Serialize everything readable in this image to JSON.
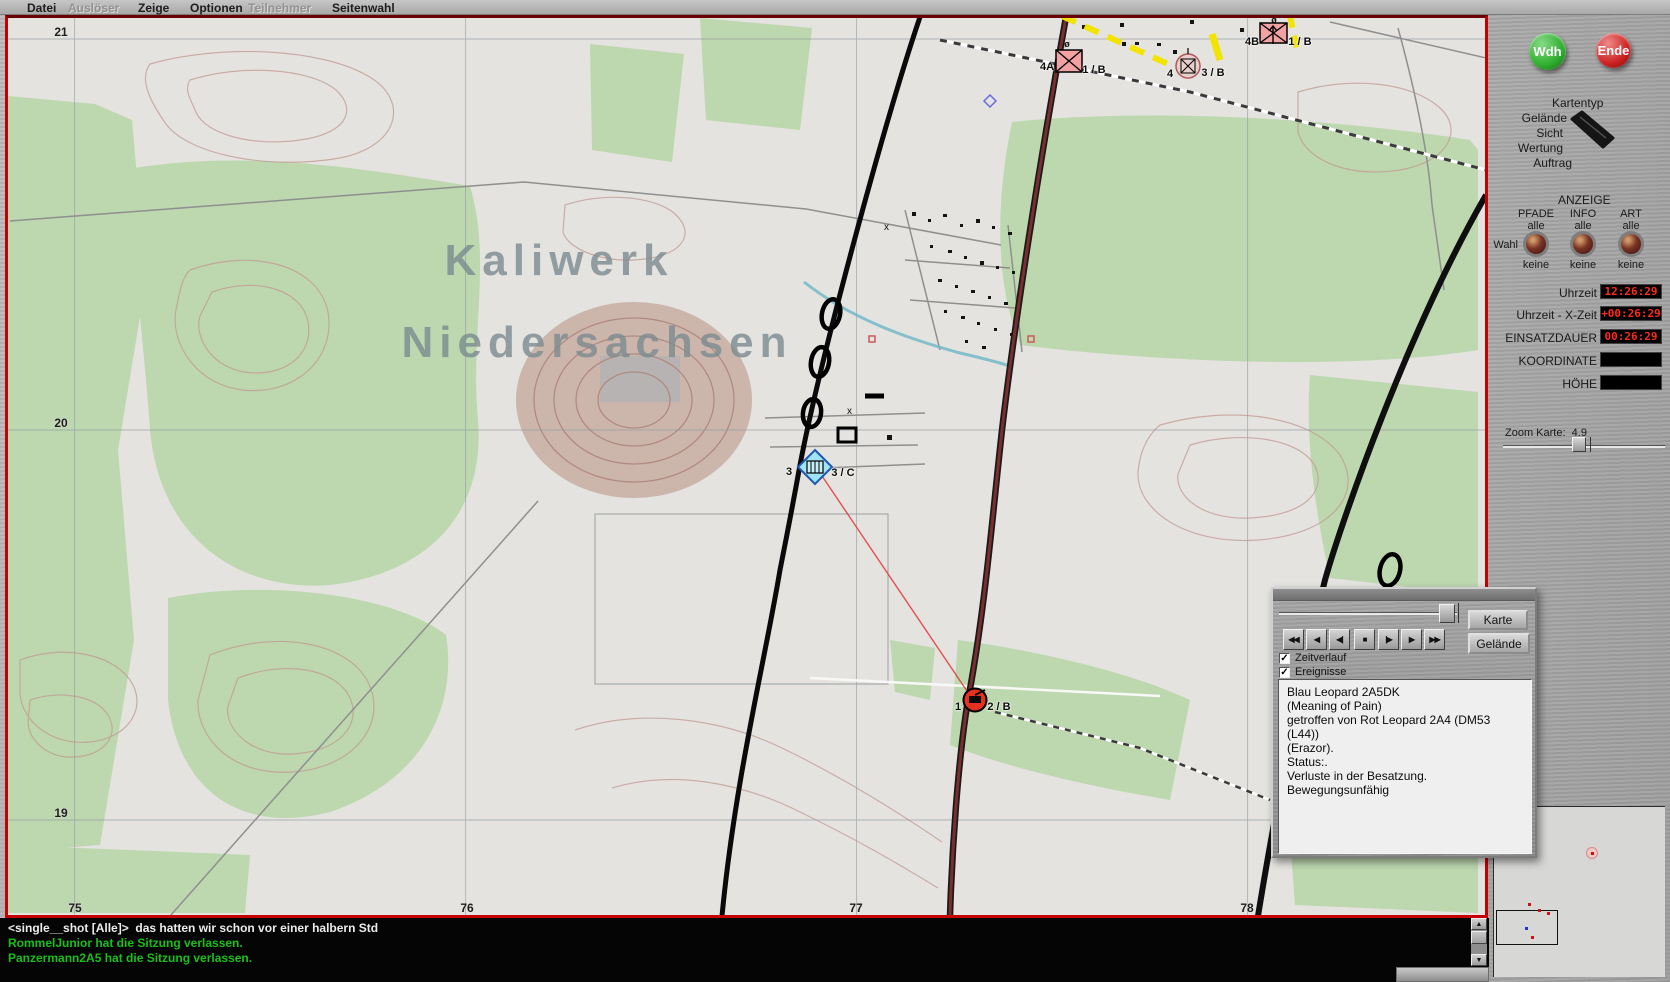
{
  "colors": {
    "metal": "#adadad",
    "led": "#ff2a1a",
    "map-border": "#c40000",
    "chat-green": "#18c018",
    "wdh-green": "#2fae2f",
    "ende-red": "#cc2222",
    "enemy-pink": "#f2a2a2",
    "friendly-blue": "#9fe4f4"
  },
  "menu": {
    "items": [
      {
        "label": "Datei",
        "enabled": true
      },
      {
        "label": "Auslöser",
        "enabled": false
      },
      {
        "label": "Zeige",
        "enabled": true
      },
      {
        "label": "Optionen",
        "enabled": true
      },
      {
        "label": "Teilnehmer",
        "enabled": false
      },
      {
        "label": "Seitenwahl",
        "enabled": true
      }
    ]
  },
  "map": {
    "watermark_line1": "Kaliwerk",
    "watermark_line2": "Niedersachsen",
    "grid": {
      "row_labels": [
        "21",
        "20",
        "19"
      ],
      "col_labels": [
        "75",
        "76",
        "77",
        "78"
      ]
    },
    "units": [
      {
        "left_label": "4A",
        "right_label": "1 / B",
        "marker": "ø"
      },
      {
        "left_label": "4",
        "right_label": "3 / B",
        "marker": ""
      },
      {
        "left_label": "4B",
        "right_label": "1 / B",
        "marker": "ø"
      },
      {
        "left_label": "3",
        "right_label": "3 / C",
        "marker": ""
      },
      {
        "left_label": "1",
        "right_label": "2 / B",
        "marker": ""
      }
    ]
  },
  "sidebar": {
    "wdh_label": "Wdh",
    "ende_label": "Ende",
    "kartentyp": {
      "title": "Kartentyp",
      "options": [
        "Gelände",
        "Sicht",
        "Wertung",
        "Auftrag"
      ],
      "selected": "Gelände"
    },
    "anzeige": {
      "title": "ANZEIGE",
      "wahl_label": "Wahl",
      "columns": [
        {
          "name": "PFADE",
          "top": "alle",
          "bottom": "keine"
        },
        {
          "name": "INFO",
          "top": "alle",
          "bottom": "keine"
        },
        {
          "name": "ART",
          "top": "alle",
          "bottom": "keine"
        }
      ]
    },
    "readouts": [
      {
        "label": "Uhrzeit",
        "value": "12:26:29"
      },
      {
        "label": "Uhrzeit - X-Zeit",
        "value": "+00:26:29"
      },
      {
        "label": "EINSATZDAUER",
        "value": "00:26:29"
      },
      {
        "label": "KOORDINATE",
        "value": ""
      },
      {
        "label": "HÖHE",
        "value": ""
      }
    ],
    "zoom_label": "Zoom Karte:",
    "zoom_value": "4.9"
  },
  "replay_panel": {
    "buttons": [
      "◀◀",
      "◀",
      "◀|",
      "■",
      "|▶",
      "▶",
      "▶▶"
    ],
    "karte_label": "Karte",
    "gelaende_label": "Gelände",
    "checkboxes": [
      {
        "label": "Zeitverlauf",
        "mark": "✓"
      },
      {
        "label": "Ereignisse",
        "mark": "✓"
      }
    ],
    "event_lines": [
      "Blau Leopard 2A5DK",
      "(Meaning of Pain)",
      "getroffen von Rot Leopard 2A4 (DM53",
      "(L44))",
      "(Erazor).",
      "Status:.",
      "Verluste in der Besatzung.",
      "Bewegungsunfähig"
    ]
  },
  "chat": {
    "lines": [
      {
        "text": "<single__shot [Alle]>  das hatten wir schon vor einer halbern Std"
      },
      {
        "text": "RommelJunior hat die Sitzung verlassen."
      },
      {
        "text": "Panzermann2A5 hat die Sitzung verlassen."
      }
    ]
  },
  "scroll": {
    "up": "▲",
    "down": "▼"
  }
}
